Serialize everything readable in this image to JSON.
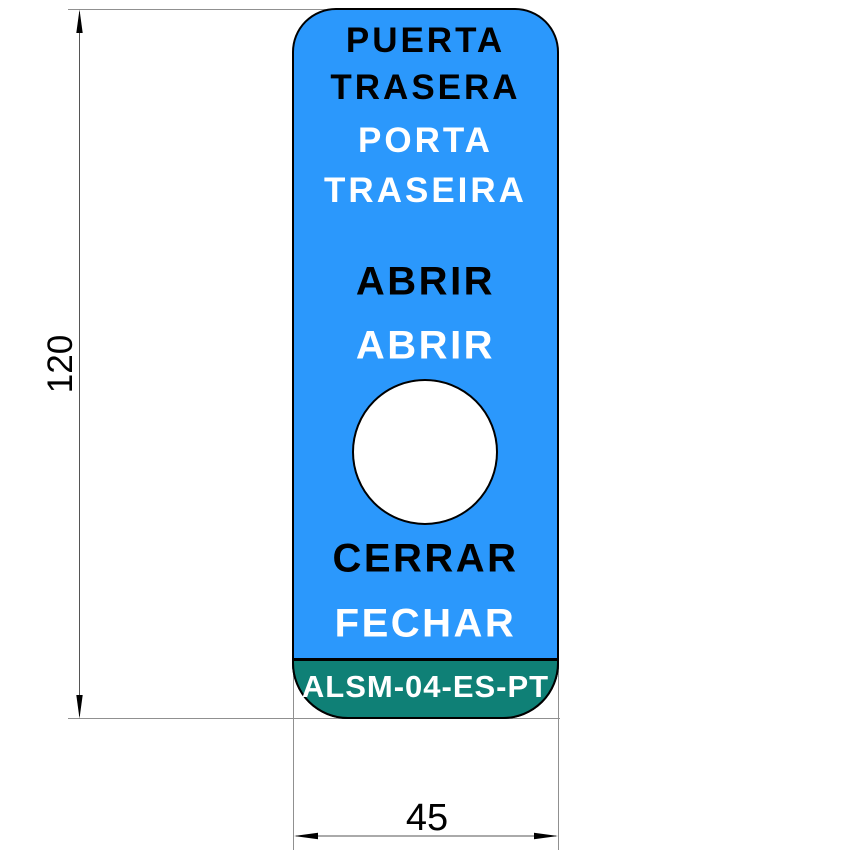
{
  "colors": {
    "label-blue": "#2B98FC",
    "footer-teal": "#0F8076",
    "outline-black": "#000000",
    "text-black": "#000000",
    "text-white": "#FFFFFF",
    "dim-line": "#555555",
    "ext-line": "#909090"
  },
  "label": {
    "lines": [
      {
        "text": "PUERTA",
        "color": "black"
      },
      {
        "text": "TRASERA",
        "color": "black"
      },
      {
        "text": "PORTA",
        "color": "white"
      },
      {
        "text": "TRASEIRA",
        "color": "white"
      },
      {
        "text": "ABRIR",
        "color": "black"
      },
      {
        "text": "ABRIR",
        "color": "white"
      },
      {
        "text": "CERRAR",
        "color": "black"
      },
      {
        "text": "FECHAR",
        "color": "white"
      }
    ],
    "footer_code": "ALSM-04-ES-PT"
  },
  "dimensions": {
    "height_mm": "120",
    "width_mm": "45"
  }
}
